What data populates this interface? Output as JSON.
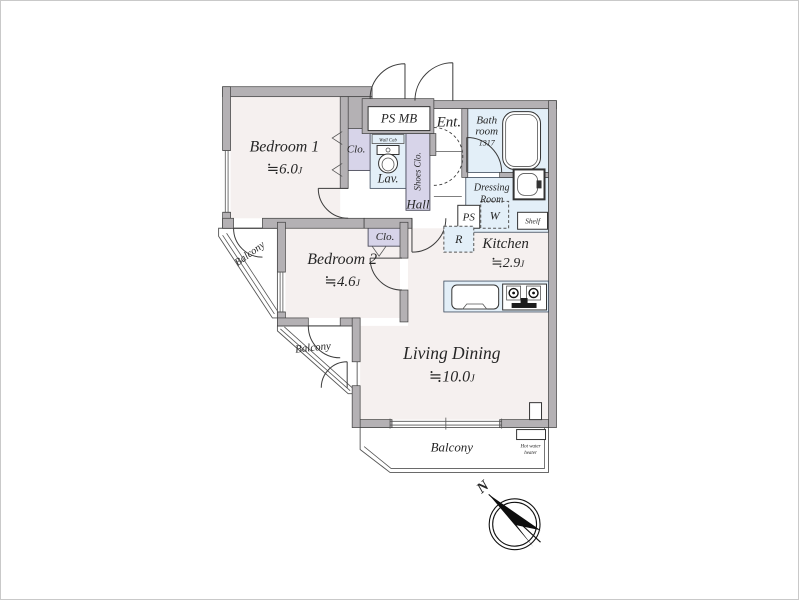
{
  "colors": {
    "floor": "#f5f0ef",
    "water": "#e3eff8",
    "closet": "#d7d4e9",
    "wall": "#b4b1b4",
    "line": "#3e3e3e"
  },
  "rooms": {
    "bedroom1": {
      "name": "Bedroom 1",
      "size": "≒6.0",
      "unit": "J"
    },
    "bedroom2": {
      "name": "Bedroom 2",
      "size": "≒4.6",
      "unit": "J"
    },
    "living_dining": {
      "name": "Living Dining",
      "size": "≒10.0",
      "unit": "J"
    },
    "kitchen": {
      "name": "Kitchen",
      "size": "≒2.9",
      "unit": "J"
    },
    "hall": {
      "name": "Hall"
    },
    "entrance": {
      "name": "Ent."
    },
    "lavatory": {
      "name": "Lav.",
      "wall_cabinet": "Wall Cab"
    },
    "bathroom": {
      "name_line1": "Bath",
      "name_line2": "room",
      "size_code": "1317"
    },
    "dressing": {
      "name_line1": "Dressing",
      "name_line2": "Room"
    }
  },
  "storage": {
    "closet1": "Clo.",
    "closet2": "Clo.",
    "shoes_closet": "Shoes Clo.",
    "pipe_meter": "PS MB",
    "pipe_shaft": "PS",
    "washer": "W",
    "shelf": "Shelf",
    "refrigerator": "R"
  },
  "balconies": {
    "upper": "Balcony",
    "lower": "Balcony",
    "main": "Balcony"
  },
  "equipment": {
    "hot_water_line1": "Hot water",
    "hot_water_line2": "heater"
  },
  "compass": {
    "north": "N"
  }
}
